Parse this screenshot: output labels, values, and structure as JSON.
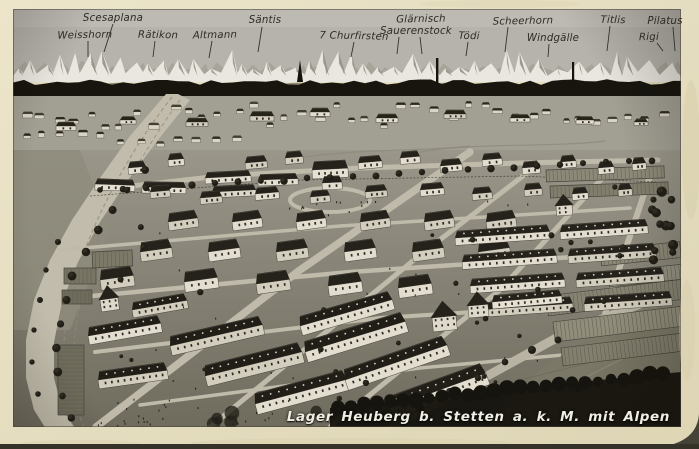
{
  "postcard": {
    "caption": "Lager Heuberg b. Stetten a. k. M. mit Alpen",
    "panorama_labels": [
      {
        "label": "Weisshorn",
        "x": 85,
        "y": 38,
        "line": [
          88,
          41,
          88,
          57
        ]
      },
      {
        "label": "Scesaplana",
        "x": 113,
        "y": 21,
        "line": [
          113,
          24,
          104,
          52
        ]
      },
      {
        "label": "Rätikon",
        "x": 158,
        "y": 38,
        "line": [
          155,
          41,
          153,
          57
        ]
      },
      {
        "label": "Altmann",
        "x": 215,
        "y": 38,
        "line": [
          212,
          41,
          209,
          58
        ]
      },
      {
        "label": "Säntis",
        "x": 265,
        "y": 23,
        "line": [
          262,
          27,
          258,
          52
        ]
      },
      {
        "label": "7 Churfirsten",
        "x": 354,
        "y": 39,
        "line": [
          354,
          42,
          351,
          57
        ]
      },
      {
        "label": "Glärnisch",
        "x": 421,
        "y": 22,
        "line": [
          399,
          37,
          397,
          54
        ]
      },
      {
        "label": "Sauerenstock",
        "x": 416,
        "y": 34,
        "line": [
          420,
          37,
          422,
          54
        ]
      },
      {
        "label": "Tödi",
        "x": 469,
        "y": 39,
        "line": [
          468,
          42,
          466,
          56
        ]
      },
      {
        "label": "Scheerhorn",
        "x": 523,
        "y": 24,
        "line": [
          508,
          27,
          505,
          52
        ]
      },
      {
        "label": "Windgälle",
        "x": 553,
        "y": 41,
        "line": [
          549,
          44,
          548,
          57
        ]
      },
      {
        "label": "Titlis",
        "x": 613,
        "y": 23,
        "line": [
          610,
          26,
          607,
          51
        ]
      },
      {
        "label": "Rigi",
        "x": 649,
        "y": 40,
        "line": [
          657,
          43,
          663,
          51
        ]
      },
      {
        "label": "Pilatus",
        "x": 665,
        "y": 24,
        "line": [
          673,
          27,
          675,
          51
        ]
      }
    ],
    "colors": {
      "card_paper": "#e8e1c6",
      "photo_sky": "#b5b3ab",
      "label_ink": "#2d2b24",
      "caption_ink": "#f0ede2"
    }
  }
}
